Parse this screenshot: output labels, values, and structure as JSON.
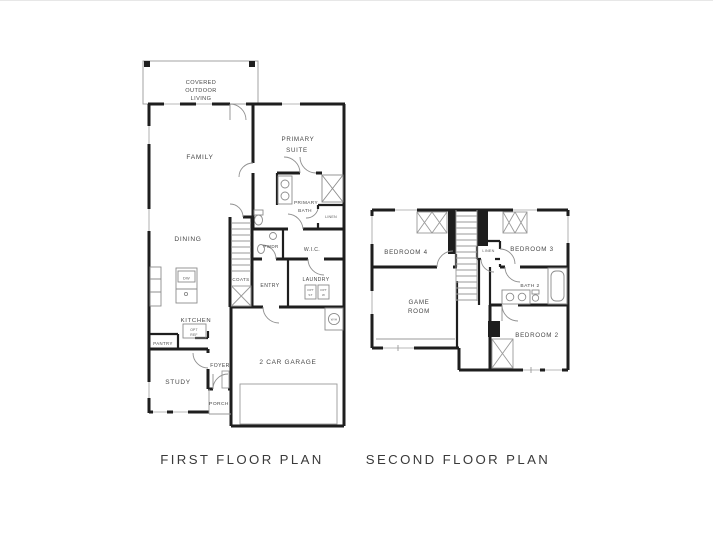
{
  "colors": {
    "background": "#ffffff",
    "wall": "#1e1e1e",
    "thin": "#9a9a9a",
    "fixture": "#8c8c8c",
    "label": "#474747",
    "caption": "#3a3a3a"
  },
  "first_floor": {
    "caption": "FIRST FLOOR PLAN",
    "covered_outdoor_living": [
      "COVERED",
      "OUTDOOR",
      "LIVING"
    ],
    "family": "FAMILY",
    "primary_suite": [
      "PRIMARY",
      "SUITE"
    ],
    "primary_bath": [
      "PRIMARY",
      "BATH"
    ],
    "linen": "LINEN",
    "dining": "DINING",
    "pwdr": "PWDR",
    "wic": "W.I.C.",
    "coats": "COATS",
    "entry": "ENTRY",
    "laundry": "LAUNDRY",
    "opt_box_1": [
      "OPT",
      "ST"
    ],
    "opt_box_2": [
      "OPT",
      "W"
    ],
    "dw": "DW",
    "kitchen": "KITCHEN",
    "pantry": "PANTRY",
    "opt_ref": [
      "OPT",
      "REF"
    ],
    "water_heater": "W/H",
    "foyer": "FOYER",
    "study": "STUDY",
    "porch": "PORCH",
    "garage": "2 CAR GARAGE"
  },
  "second_floor": {
    "caption": "SECOND FLOOR PLAN",
    "bedroom_4": "BEDROOM 4",
    "linen": "LINEN",
    "bedroom_3": "BEDROOM 3",
    "bath_2": "BATH 2",
    "game_room": [
      "GAME",
      "ROOM"
    ],
    "bedroom_2": "BEDROOM 2"
  }
}
